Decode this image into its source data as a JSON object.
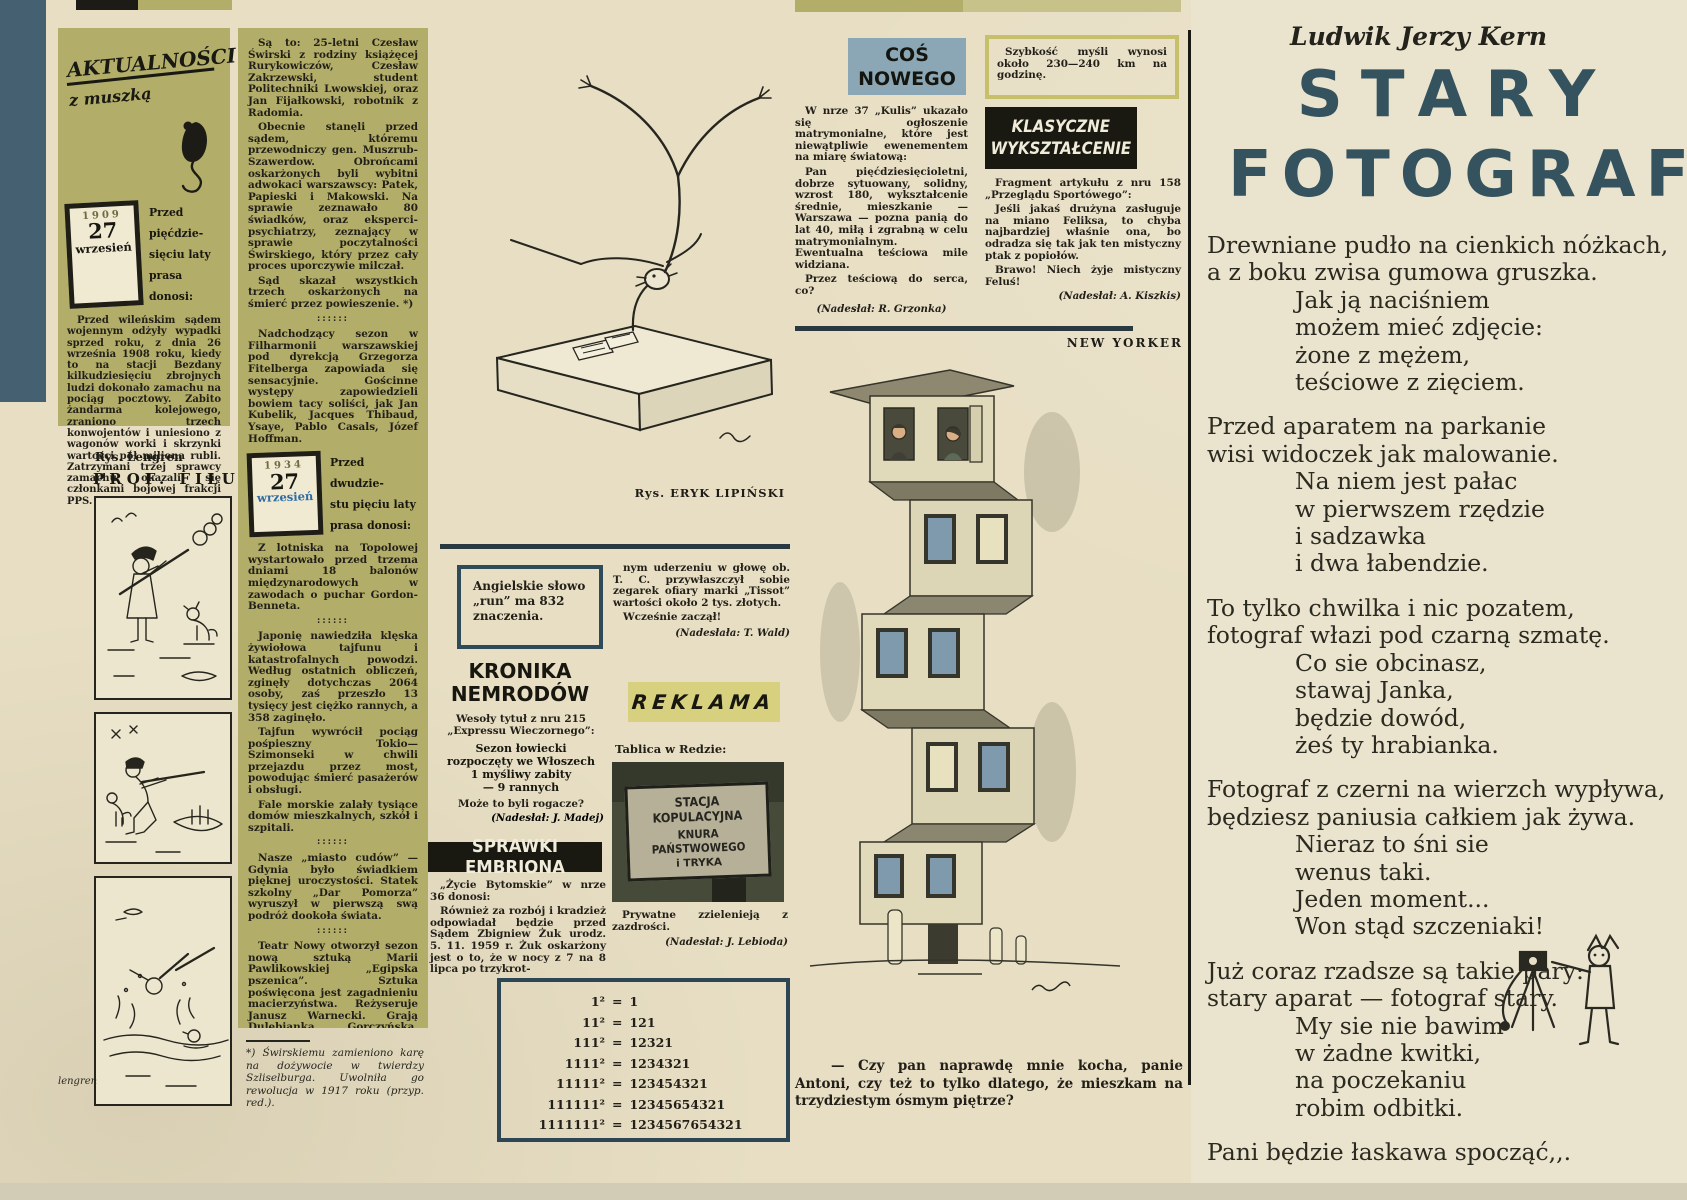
{
  "sep": "::::::",
  "masthead": {
    "logo_line1": "AKTUALNOŚCI",
    "logo_line2": "z muszką"
  },
  "badges": {
    "b1909": {
      "year": "1909",
      "day": "27",
      "month": "wrzesień",
      "lead": "Przed pięćdzie-\nsięciu laty\nprasa donosi:"
    },
    "b1934": {
      "year": "1934",
      "day": "27",
      "month": "wrzesień",
      "lead": "Przed dwudzie-\nstu pięciu laty\nprasa donosi:"
    }
  },
  "col_a": {
    "para": "Przed wileńskim sądem wojennym odżyły wypadki sprzed roku, z dnia 26 września 1908 roku, kiedy to na stacji Bezdany kilkudziesięciu zbrojnych ludzi dokonało zamachu na pociąg pocztowy. Zabito żandarma kolejowego, zraniono trzech konwojentów i uniesiono z wagonów worki i skrzynki wartości pół miliona rubli. Zatrzymani trzej sprawcy zamachu okazali się członkami bojowej frakcji PPS.",
    "rys": "Rys. Lengren",
    "comic_title": "PROF. FILUTEK",
    "signature": "lengren"
  },
  "col_b": {
    "paras": [
      "Są to: 25-letni Czesław Świrski z rodziny książęcej Rurykowiczów, Czesław Zakrzewski, student Politechniki Lwowskiej, oraz Jan Fijałkowski, robotnik z Radomia.",
      "Obecnie stanęli przed sądem, któremu przewodniczy gen. Muszrub-Szawerdow. Obrońcami oskarżonych byli wybitni adwokaci warszawscy: Patek, Papieski i Makowski. Na sprawie zeznawało 80 świadków, oraz eksperci-psychiatrzy, zeznający w sprawie poczytalności Świrskiego, który przez cały proces uporczywie milczał.",
      "Sąd skazał wszystkich trzech oskarżonych na śmierć przez powieszenie. *)",
      "Nadchodzący sezon w Filharmonii warszawskiej pod dyrekcją Grzegorza Fitelberga zapowiada się sensacyjnie. Gościnne występy zapowiedzieli bowiem tacy soliści, jak Jan Kubelik, Jacques Thibaud, Ysaye, Pablo Casals, Józef Hoffman.",
      "Z lotniska na Topolowej wystartowało przed trzema dniami 18 balonów międzynarodowych w zawodach o puchar Gordon-Benneta.",
      "Japonię nawiedziła klęska żywiołowa tajfunu i katastrofalnych powodzi. Według ostatnich obliczeń, zginęły dotychczas 2064 osoby, zaś przeszło 13 tysięcy jest ciężko rannych, a 358 zaginęło.",
      "Tajfun wywrócił pociąg pośpieszny Tokio—Szimonseki w chwili przejazdu przez most, powodując śmierć pasażerów i obsługi.",
      "Fale morskie zalały tysiące domów mieszkalnych, szkół i szpitali.",
      "Nasze „miasto cudów” — Gdynia było świadkiem pięknej uroczystości. Statek szkolny „Dar Pomorza” wyruszył w pierwszą swą podróż dookoła świata.",
      "Teatr Nowy otworzył sezon nową sztuką Marii Pawlikowskiej „Egipska pszenica”. Sztuka poświęcona jest zagadnieniu macierzyństwa. Reżyseruje Janusz Warnecki. Grają Dulębianka, Gorczyńska, Buczyńska, Brodniewicz i Pośpielowski."
    ],
    "credit": "(kar. beyl.)",
    "footnote": "*) Świrskiemu zamieniono karę na dożywocie w twierdzy Szliselburga. Uwolniła go rewolucja w 1917 roku (przyp. red.)."
  },
  "middle": {
    "rys_caption": "Rys. ERYK LIPIŃSKI",
    "run_box": "Angielskie słowo\n„run” ma 832 znaczenia.",
    "kronika": {
      "title": "KRONIKA\nNEMRODÓW",
      "intro": "Wesoły tytuł z nru 215 „Expressu Wieczornego”:",
      "quote": "Sezon łowiecki\nrozpoczęty we Włoszech\n1 myśliwy zabity\n— 9 rannych",
      "comment": "Może to byli rogacze?",
      "credit": "(Nadesłał: J. Madej)"
    },
    "sprawki": {
      "title": "SPRAWKI EMBRIONA",
      "intro": "„Życie Bytomskie” w nrze 36 donosi:",
      "para": "Również za rozbój i kradzież odpowiadał będzie przed Sądem Zbigniew Żuk urodz. 5. 11. 1959 r. Żuk oskarżony jest o to, że w nocy z 7 na 8 lipca po trzykrot-",
      "para2": "nym uderzeniu w głowę ob. T. C. przywłaszczył sobie zegarek ofiary marki „Tissot” wartości około 2 tys. złotych.",
      "exclaim": "Wcześnie zaczął!",
      "credit": "(Nadesłała: T. Wald)"
    },
    "reklama": {
      "label": "REKLAMA",
      "intro": "Tablica w Redzie:",
      "sign_line1": "STACJA KOPULACYJNA",
      "sign_line2": "KNURA PAŃSTWOWEGO",
      "sign_line3": "i TRYKA",
      "after": "Prywatne zzielenieją z zazdrości.",
      "credit": "(Nadesłał: J. Lebioda)"
    },
    "math_rows": [
      [
        "1²",
        "1"
      ],
      [
        "11²",
        "121"
      ],
      [
        "111²",
        "12321"
      ],
      [
        "1111²",
        "1234321"
      ],
      [
        "11111²",
        "123454321"
      ],
      [
        "111111²",
        "12345654321"
      ],
      [
        "1111111²",
        "1234567654321"
      ]
    ]
  },
  "cos_nowego": {
    "banner": "COŚ\nNOWEGO",
    "p1": "W nrze 37 „Kulis” ukazało się ogłoszenie matrymonialne, które jest niewątpliwie ewenementem na miarę światową:",
    "p2": "Pan pięćdziesięcioletni, dobrze sytuowany, solidny, wzrost 180, wykształcenie średnie, mieszkanie — Warszawa — pozna panią do lat 40, miłą i zgrabną w celu matrymonialnym. Ewentualna teściowa mile widziana.",
    "p3": "Przez teściową do serca, co?",
    "credit": "(Nadesłał: R. Grzonka)"
  },
  "szybkosc": "Szybkość myśli wynosi około 230—240 km na godzinę.",
  "klasyczne": {
    "banner": "KLASYCZNE\nWYKSZTAŁCENIE",
    "intro": "Fragment artykułu z nru 158 „Przeglądu Sportówego”:",
    "p1": "Jeśli jakaś drużyna zasługuje na miano Feliksa, to chyba najbardziej właśnie ona, bo odradza się tak jak ten mistyczny ptak z popiołów.",
    "p2": "Brawo! Niech żyje mistyczny Feluś!",
    "credit": "(Nadesłał: A. Kiszkis)"
  },
  "cartoon": {
    "label": "NEW YORKER",
    "caption": "— Czy pan naprawdę mnie kocha, panie Antoni, czy też to tylko dlatego, że mieszkam na trzydziestym ósmym piętrze?"
  },
  "poem": {
    "author": "Ludwik Jerzy Kern",
    "title1": "STARY",
    "title2": "FOTOGRAF",
    "s1w": "Drewniane pudło na cienkich nóżkach,\na z boku zwisa gumowa gruszka.",
    "s1i": "Jak ją naciśniem\nmożem mieć zdjęcie:\nżone z mężem,\nteściowe z zięciem.",
    "s2w": "Przed aparatem na parkanie\nwisi widoczek jak malowanie.",
    "s2i": "Na niem jest pałac\nw pierwszem rzędzie\ni sadzawka\ni dwa łabendzie.",
    "s3w": "To tylko chwilka i nic pozatem,\nfotograf włazi pod czarną szmatę.",
    "s3i": "Co sie obcinasz,\nstawaj Janka,\nbędzie dowód,\nżeś ty hrabianka.",
    "s4w": "Fotograf z czerni na wierzch wypływa,\nbędziesz paniusia całkiem jak żywa.",
    "s4i": "Nieraz to śni sie\nwenus taki.\nJeden moment...\nWon stąd szczeniaki!",
    "s5w": "Już coraz rzadsze są takie pary:\nstary aparat — fotograf stary.",
    "s5i": "My sie nie bawim\nw żadne kwitki,\nna poczekaniu\nrobim odbitki.",
    "final": "Pani będzie łaskawa spocząć,,."
  }
}
